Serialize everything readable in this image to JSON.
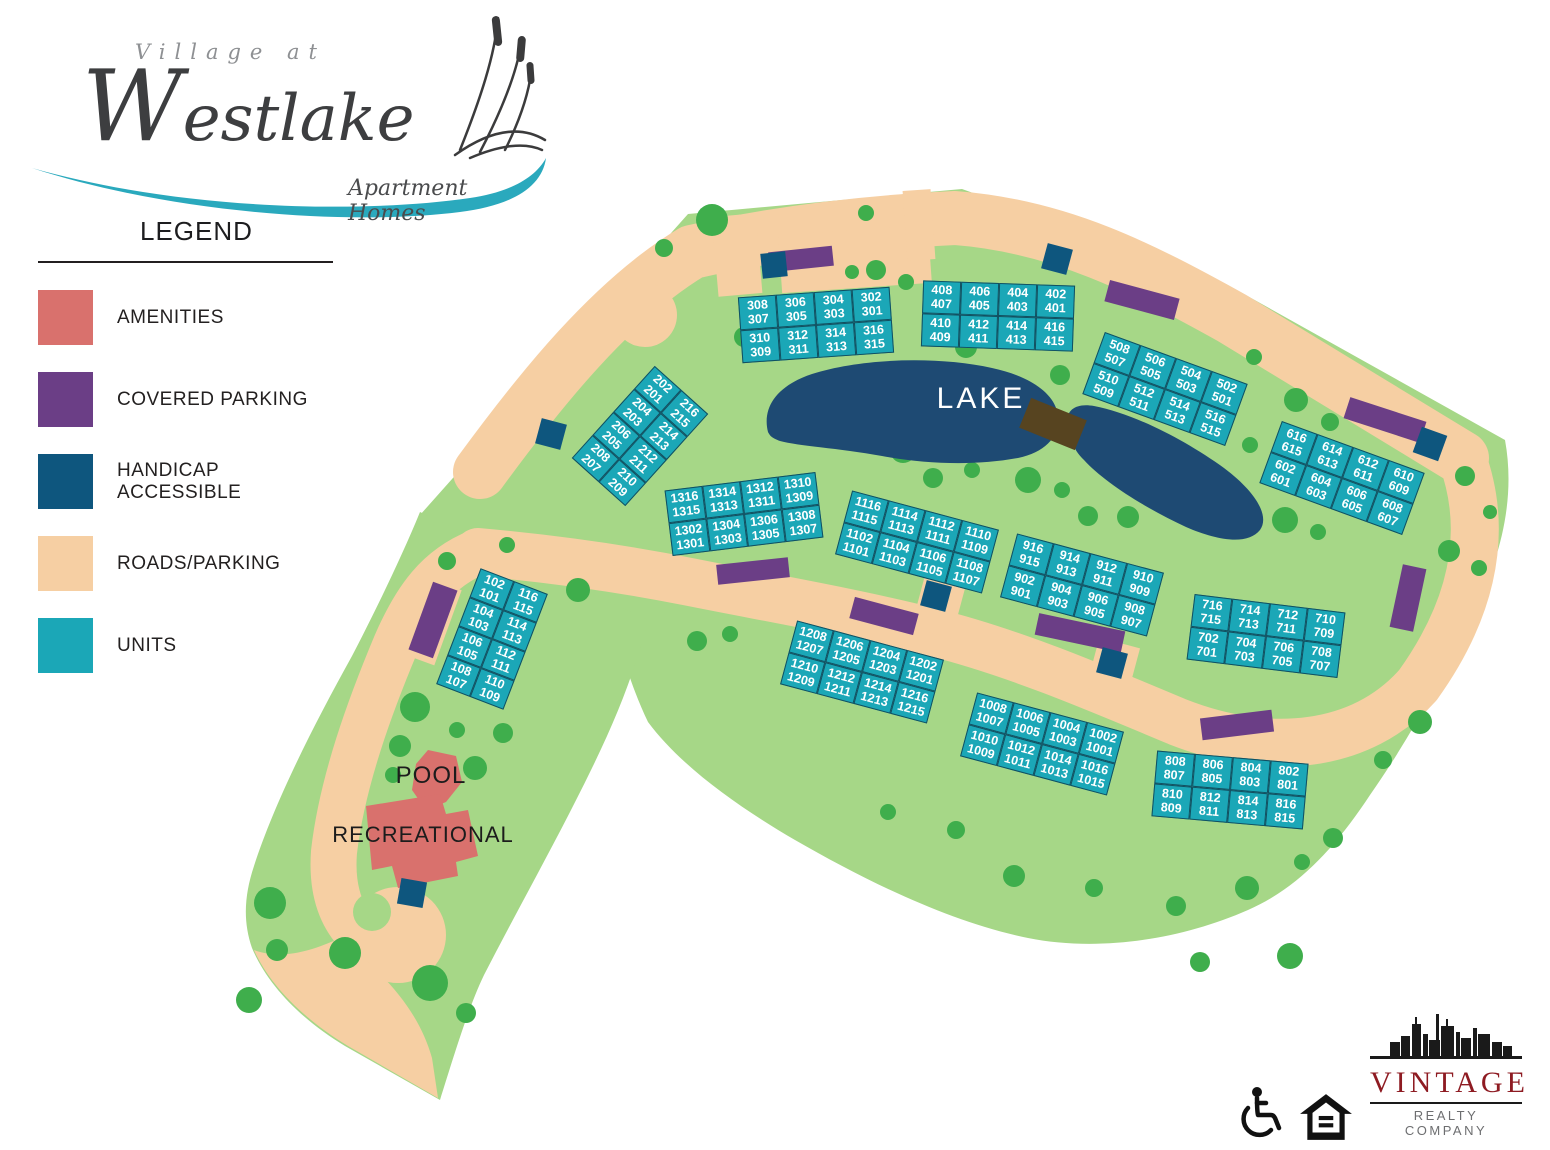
{
  "logo": {
    "village_at": "Village at",
    "westlake": "Westlake",
    "tagline": "Apartment Homes"
  },
  "legend": {
    "title": "LEGEND",
    "items": [
      {
        "label": "AMENITIES",
        "color": "#d9716d"
      },
      {
        "label": "COVERED PARKING",
        "color": "#6b3e86"
      },
      {
        "label": "HANDICAP ACCESSIBLE",
        "color": "#0e567e"
      },
      {
        "label": "ROADS/PARKING",
        "color": "#f6cfa3"
      },
      {
        "label": "UNITS",
        "color": "#1ba7b7"
      }
    ]
  },
  "map": {
    "labels": {
      "lake": "LAKE",
      "pool": "POOL",
      "recreational": "RECREATIONAL"
    },
    "colors": {
      "site_green": "#a6d787",
      "tree_green": "#3fae4c",
      "road": "#f6cfa3",
      "units": "#1ba7b7",
      "unit_border": "#124f60",
      "lake": "#1e4a73",
      "bridge": "#574420",
      "amenities": "#d9716d",
      "covered_parking": "#6b3e86",
      "handicap": "#0e567e"
    },
    "buildings": [
      {
        "id": "100",
        "cx": 492,
        "cy": 639,
        "rot": 21,
        "cols": 2,
        "rows": 4,
        "cellW": 36,
        "cellH": 31,
        "cells": [
          [
            [
              "102",
              "101"
            ],
            [
              "116",
              "115"
            ]
          ],
          [
            [
              "104",
              "103"
            ],
            [
              "114",
              "113"
            ]
          ],
          [
            [
              "106",
              "105"
            ],
            [
              "112",
              "111"
            ]
          ],
          [
            [
              "108",
              "107"
            ],
            [
              "110",
              "109"
            ]
          ]
        ]
      },
      {
        "id": "200",
        "cx": 640,
        "cy": 436,
        "rot": 42,
        "cols": 2,
        "rows": 4,
        "cellW": 36,
        "cellH": 31,
        "cells": [
          [
            [
              "202",
              "201"
            ],
            [
              "216",
              "215"
            ]
          ],
          [
            [
              "204",
              "203"
            ],
            [
              "214",
              "213"
            ]
          ],
          [
            [
              "206",
              "205"
            ],
            [
              "212",
              "211"
            ]
          ],
          [
            [
              "208",
              "207"
            ],
            [
              "210",
              "209"
            ]
          ]
        ]
      },
      {
        "id": "300",
        "cx": 816,
        "cy": 325,
        "rot": -4,
        "cols": 4,
        "rows": 2,
        "cellW": 38,
        "cellH": 33,
        "cells": [
          [
            [
              "308",
              "307"
            ],
            [
              "306",
              "305"
            ],
            [
              "304",
              "303"
            ],
            [
              "302",
              "301"
            ]
          ],
          [
            [
              "310",
              "309"
            ],
            [
              "312",
              "311"
            ],
            [
              "314",
              "313"
            ],
            [
              "316",
              "315"
            ]
          ]
        ]
      },
      {
        "id": "400",
        "cx": 998,
        "cy": 316,
        "rot": 2,
        "cols": 4,
        "rows": 2,
        "cellW": 38,
        "cellH": 33,
        "cells": [
          [
            [
              "408",
              "407"
            ],
            [
              "406",
              "405"
            ],
            [
              "404",
              "403"
            ],
            [
              "402",
              "401"
            ]
          ],
          [
            [
              "410",
              "409"
            ],
            [
              "412",
              "411"
            ],
            [
              "414",
              "413"
            ],
            [
              "416",
              "415"
            ]
          ]
        ]
      },
      {
        "id": "500",
        "cx": 1165,
        "cy": 389,
        "rot": 20,
        "cols": 4,
        "rows": 2,
        "cellW": 38,
        "cellH": 33,
        "cells": [
          [
            [
              "508",
              "507"
            ],
            [
              "506",
              "505"
            ],
            [
              "504",
              "503"
            ],
            [
              "502",
              "501"
            ]
          ],
          [
            [
              "510",
              "509"
            ],
            [
              "512",
              "511"
            ],
            [
              "514",
              "513"
            ],
            [
              "516",
              "515"
            ]
          ]
        ]
      },
      {
        "id": "600",
        "cx": 1342,
        "cy": 478,
        "rot": 20,
        "cols": 4,
        "rows": 2,
        "cellW": 38,
        "cellH": 33,
        "cells": [
          [
            [
              "616",
              "615"
            ],
            [
              "614",
              "613"
            ],
            [
              "612",
              "611"
            ],
            [
              "610",
              "609"
            ]
          ],
          [
            [
              "602",
              "601"
            ],
            [
              "604",
              "603"
            ],
            [
              "606",
              "605"
            ],
            [
              "608",
              "607"
            ]
          ]
        ]
      },
      {
        "id": "700",
        "cx": 1266,
        "cy": 636,
        "rot": 7,
        "cols": 4,
        "rows": 2,
        "cellW": 38,
        "cellH": 33,
        "cells": [
          [
            [
              "716",
              "715"
            ],
            [
              "714",
              "713"
            ],
            [
              "712",
              "711"
            ],
            [
              "710",
              "709"
            ]
          ],
          [
            [
              "702",
              "701"
            ],
            [
              "704",
              "703"
            ],
            [
              "706",
              "705"
            ],
            [
              "708",
              "707"
            ]
          ]
        ]
      },
      {
        "id": "800",
        "cx": 1230,
        "cy": 790,
        "rot": 5,
        "cols": 4,
        "rows": 2,
        "cellW": 38,
        "cellH": 33,
        "cells": [
          [
            [
              "808",
              "807"
            ],
            [
              "806",
              "805"
            ],
            [
              "804",
              "803"
            ],
            [
              "802",
              "801"
            ]
          ],
          [
            [
              "810",
              "809"
            ],
            [
              "812",
              "811"
            ],
            [
              "814",
              "813"
            ],
            [
              "816",
              "815"
            ]
          ]
        ]
      },
      {
        "id": "900",
        "cx": 1082,
        "cy": 585,
        "rot": 15,
        "cols": 4,
        "rows": 2,
        "cellW": 38,
        "cellH": 33,
        "cells": [
          [
            [
              "916",
              "915"
            ],
            [
              "914",
              "913"
            ],
            [
              "912",
              "911"
            ],
            [
              "910",
              "909"
            ]
          ],
          [
            [
              "902",
              "901"
            ],
            [
              "904",
              "903"
            ],
            [
              "906",
              "905"
            ],
            [
              "908",
              "907"
            ]
          ]
        ]
      },
      {
        "id": "1000",
        "cx": 1042,
        "cy": 744,
        "rot": 15,
        "cols": 4,
        "rows": 2,
        "cellW": 38,
        "cellH": 33,
        "cells": [
          [
            [
              "1008",
              "1007"
            ],
            [
              "1006",
              "1005"
            ],
            [
              "1004",
              "1003"
            ],
            [
              "1002",
              "1001"
            ]
          ],
          [
            [
              "1010",
              "1009"
            ],
            [
              "1012",
              "1011"
            ],
            [
              "1014",
              "1013"
            ],
            [
              "1016",
              "1015"
            ]
          ]
        ]
      },
      {
        "id": "1100",
        "cx": 917,
        "cy": 542,
        "rot": 15,
        "cols": 4,
        "rows": 2,
        "cellW": 38,
        "cellH": 33,
        "cells": [
          [
            [
              "1116",
              "1115"
            ],
            [
              "1114",
              "1113"
            ],
            [
              "1112",
              "1111"
            ],
            [
              "1110",
              "1109"
            ]
          ],
          [
            [
              "1102",
              "1101"
            ],
            [
              "1104",
              "1103"
            ],
            [
              "1106",
              "1105"
            ],
            [
              "1108",
              "1107"
            ]
          ]
        ]
      },
      {
        "id": "1200",
        "cx": 862,
        "cy": 672,
        "rot": 15,
        "cols": 4,
        "rows": 2,
        "cellW": 38,
        "cellH": 33,
        "cells": [
          [
            [
              "1208",
              "1207"
            ],
            [
              "1206",
              "1205"
            ],
            [
              "1204",
              "1203"
            ],
            [
              "1202",
              "1201"
            ]
          ],
          [
            [
              "1210",
              "1209"
            ],
            [
              "1212",
              "1211"
            ],
            [
              "1214",
              "1213"
            ],
            [
              "1216",
              "1215"
            ]
          ]
        ]
      },
      {
        "id": "1300",
        "cx": 744,
        "cy": 514,
        "rot": -7,
        "cols": 4,
        "rows": 2,
        "cellW": 38,
        "cellH": 33,
        "cells": [
          [
            [
              "1316",
              "1315"
            ],
            [
              "1314",
              "1313"
            ],
            [
              "1312",
              "1311"
            ],
            [
              "1310",
              "1309"
            ]
          ],
          [
            [
              "1302",
              "1301"
            ],
            [
              "1304",
              "1303"
            ],
            [
              "1306",
              "1305"
            ],
            [
              "1308",
              "1307"
            ]
          ]
        ]
      }
    ],
    "covered_parking": [
      {
        "cx": 801,
        "cy": 259,
        "w": 64,
        "h": 20,
        "rot": -6
      },
      {
        "cx": 1142,
        "cy": 300,
        "w": 72,
        "h": 22,
        "rot": 15
      },
      {
        "cx": 1385,
        "cy": 420,
        "w": 80,
        "h": 22,
        "rot": 18
      },
      {
        "cx": 1408,
        "cy": 598,
        "w": 24,
        "h": 64,
        "rot": 12
      },
      {
        "cx": 753,
        "cy": 571,
        "w": 72,
        "h": 20,
        "rot": -6
      },
      {
        "cx": 884,
        "cy": 616,
        "w": 66,
        "h": 22,
        "rot": 15
      },
      {
        "cx": 1080,
        "cy": 633,
        "w": 88,
        "h": 22,
        "rot": 12
      },
      {
        "cx": 1237,
        "cy": 725,
        "w": 72,
        "h": 22,
        "rot": -7
      },
      {
        "cx": 433,
        "cy": 620,
        "w": 26,
        "h": 72,
        "rot": 20
      }
    ],
    "handicap_spots": [
      {
        "cx": 774,
        "cy": 265,
        "s": 25,
        "rot": -6
      },
      {
        "cx": 1057,
        "cy": 259,
        "s": 26,
        "rot": 15
      },
      {
        "cx": 1430,
        "cy": 444,
        "s": 27,
        "rot": 20
      },
      {
        "cx": 551,
        "cy": 434,
        "s": 26,
        "rot": 15
      },
      {
        "cx": 936,
        "cy": 596,
        "s": 26,
        "rot": 15
      },
      {
        "cx": 1112,
        "cy": 663,
        "s": 26,
        "rot": 15
      },
      {
        "cx": 412,
        "cy": 893,
        "s": 26,
        "rot": 10
      }
    ]
  },
  "footer": {
    "brand": "VINTAGE",
    "brand_sub": "REALTY COMPANY"
  }
}
